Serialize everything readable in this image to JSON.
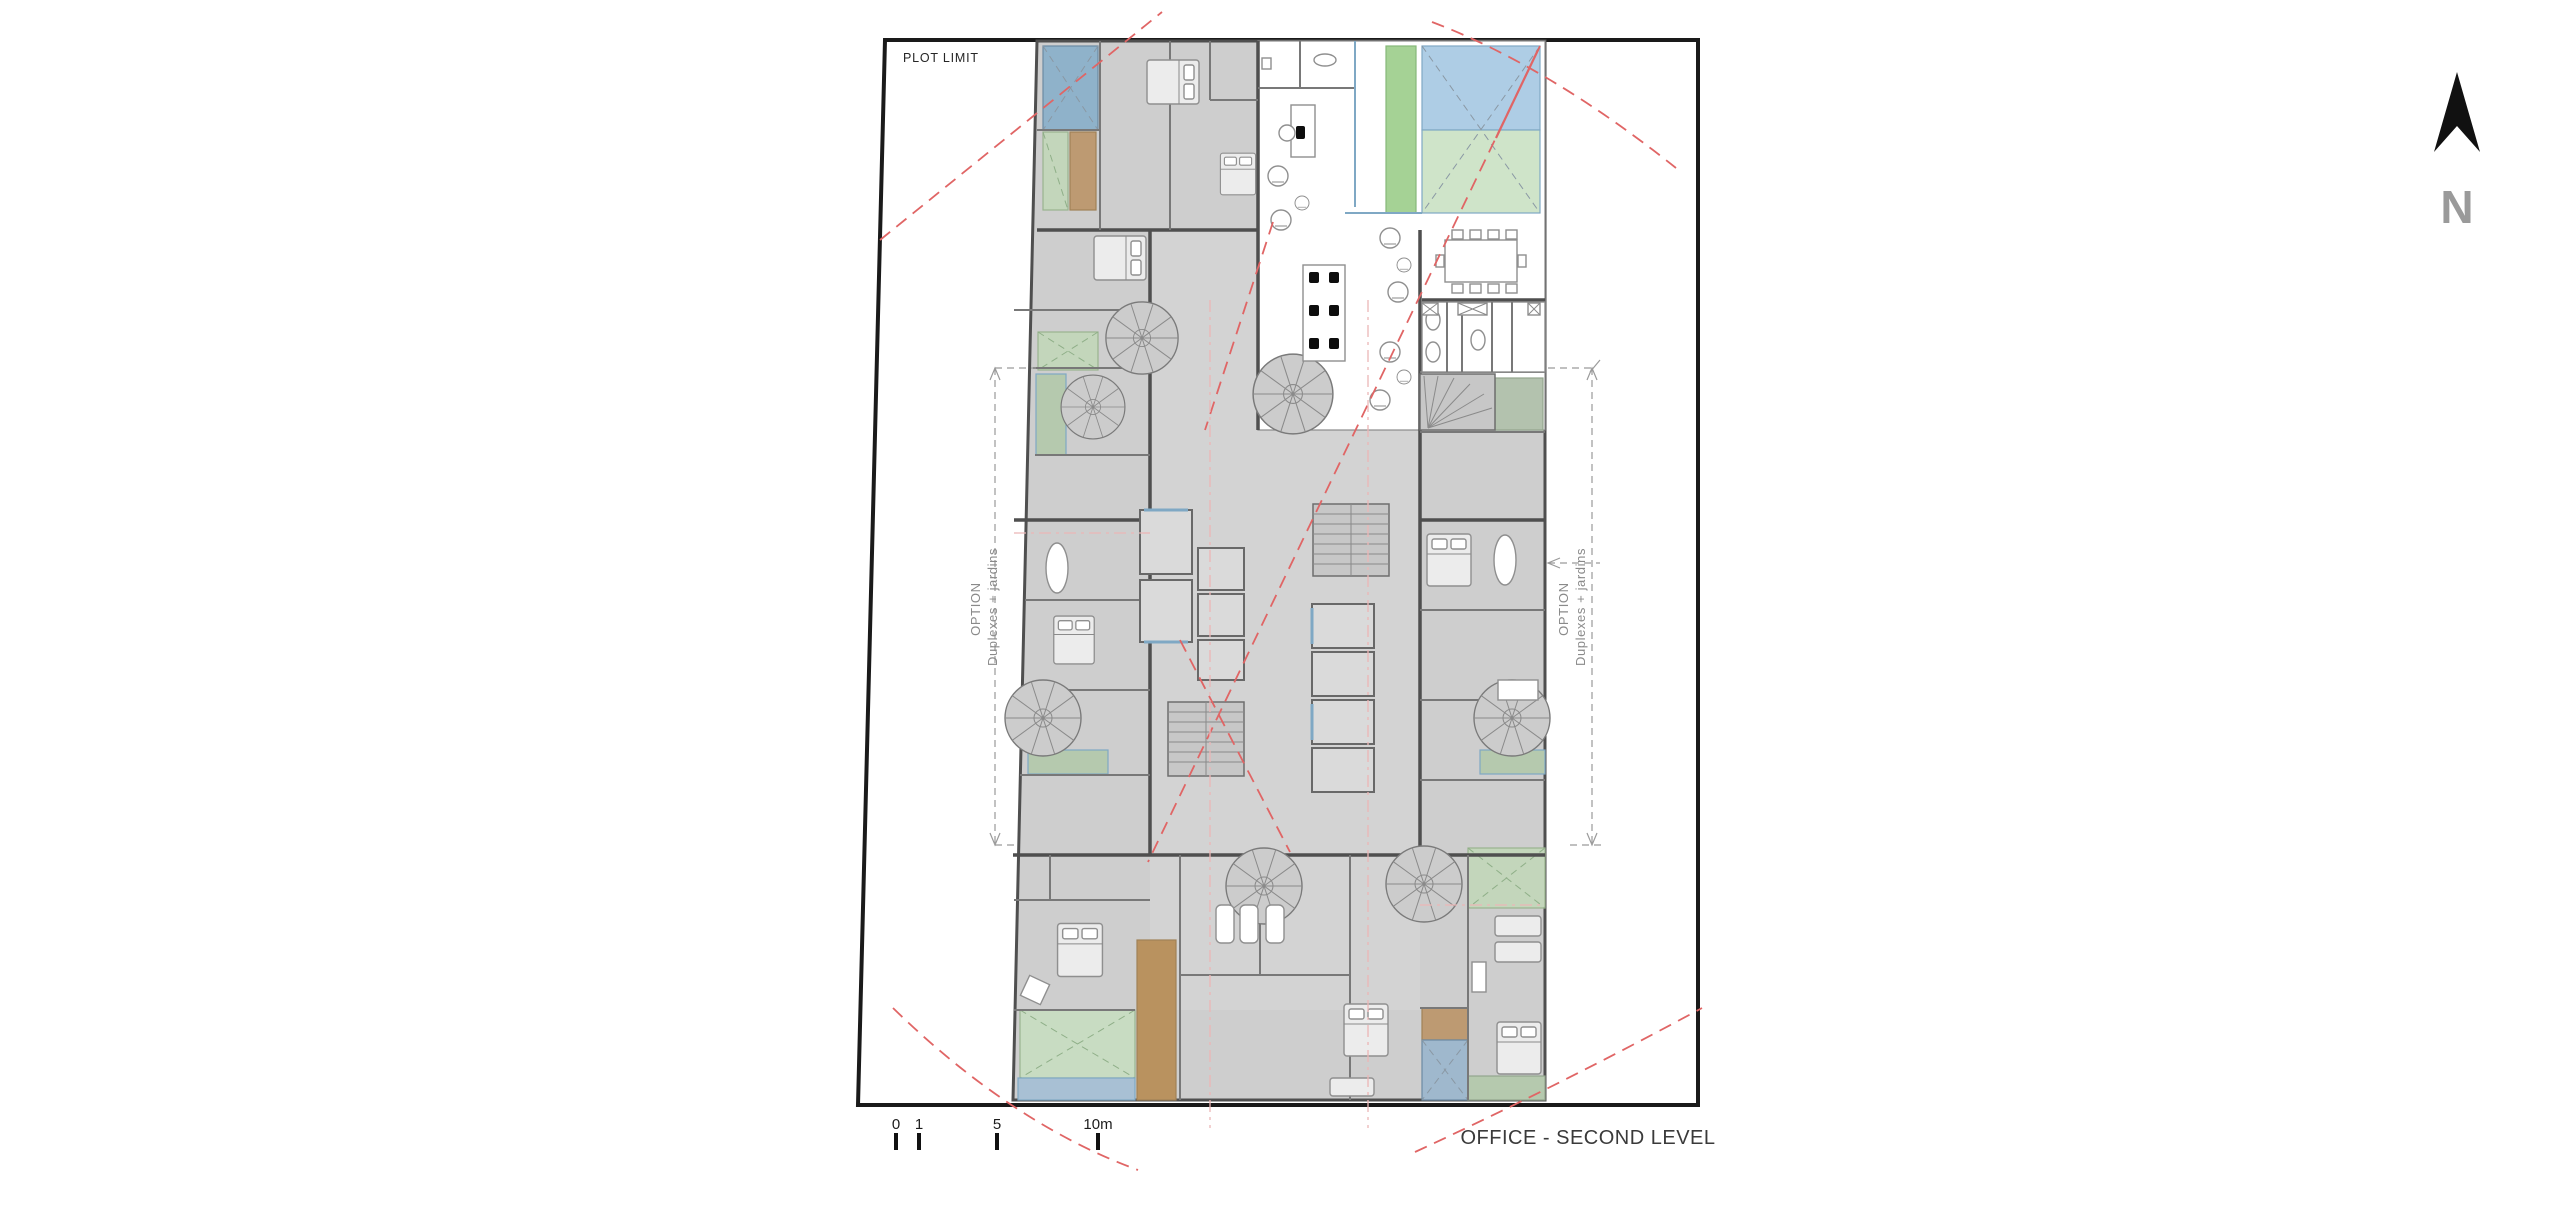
{
  "title": "OFFICE - SECOND LEVEL",
  "plot_limit_label": "PLOT LIMIT",
  "north_label": "N",
  "option_left": {
    "line1": "OPTION",
    "line2": "Duplexes + jardins"
  },
  "option_right": {
    "line1": "OPTION",
    "line2": "Duplexes + jardins"
  },
  "scale_bar": {
    "ticks": [
      {
        "label": "0"
      },
      {
        "label": "1"
      },
      {
        "label": "5"
      },
      {
        "label": "10m"
      }
    ]
  },
  "colors": {
    "plot-line": "#1a1a1a",
    "bldg-gray": "#cecece",
    "wall": "#787878",
    "wall-heavy": "#4f4f4f",
    "sky-blue": "#aecde5",
    "sky-green": "#cfe4c9",
    "accent-green": "#a5d295",
    "zone-blue": "#8fb2ca",
    "zone-green": "#c3d6bb",
    "zone-brown": "#bd9a72",
    "zone-brown-dark": "#b9925f",
    "band-green": "#b5c9ae",
    "band-blue": "#a8c0d4",
    "stair-fill": "#c7c7c7",
    "shaft-fill": "#dadada",
    "glass-blue": "#7fa8c4",
    "red-line": "#e06565",
    "pink-line": "#ecb6b6",
    "dim-line": "#9a9a9a",
    "label-gray": "#8a8a8a",
    "title-color": "#3a3a3a",
    "north-gray": "#9a9a9a"
  }
}
